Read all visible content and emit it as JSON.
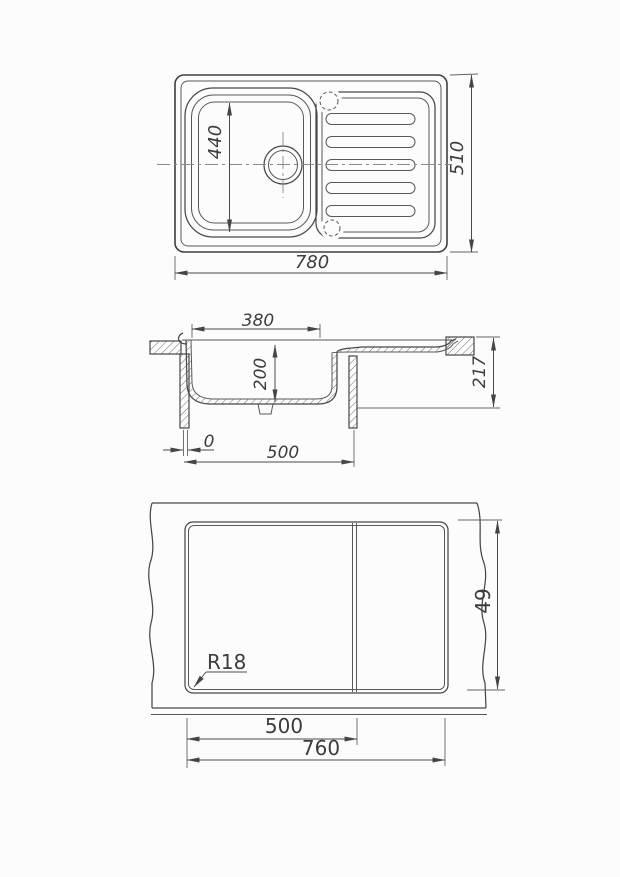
{
  "sheet": {
    "background": "#fcfcfc",
    "ink": "#3f3f3f",
    "dim_ink": "#4a4a4a",
    "centerline_ink": "#8a8a8a"
  },
  "views": {
    "top_view": {
      "dims": {
        "bowl_length": "440",
        "overall_length": "780",
        "overall_width": "510"
      }
    },
    "section_view": {
      "dims": {
        "bowl_opening": "380",
        "bowl_depth": "200",
        "overall_height": "217",
        "edge_offset": "0",
        "cabinet_width": "500"
      }
    },
    "cutout_view": {
      "dims": {
        "corner_radius": "R18",
        "left_section": "500",
        "cutout_length": "760",
        "cutout_width": "49"
      }
    }
  }
}
